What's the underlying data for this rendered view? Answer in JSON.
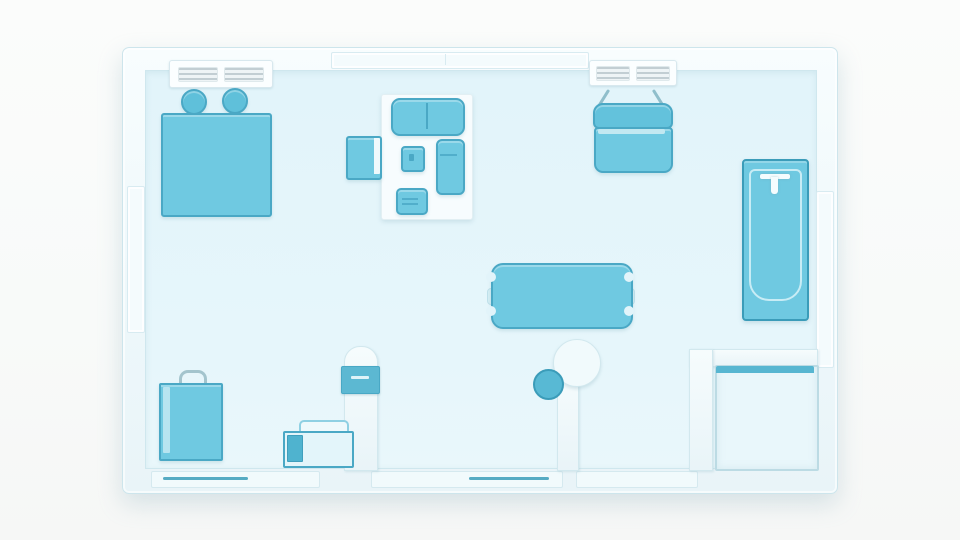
{
  "scene": {
    "title": "Apartment floor plan - top-down 3D illustration",
    "visible_text": "none"
  },
  "palette": {
    "page_bg": "#fafbfa",
    "wall_fill": "#eef8fb",
    "wall_edge": "#cde5ec",
    "wall_highlight": "#f8fdfe",
    "floor": "#e2f4fa",
    "furniture": "#6fc9e1",
    "furniture_edge": "#4aa8c5",
    "accent_dark": "#3b9cb9",
    "panel_teal": "#5cb8d2",
    "rug": "#f7fcfe",
    "window_fill": "#f4fbfd",
    "vent_slat": "#c2ced3",
    "appliance_body": "#e3f5fa",
    "shadow": "rgba(140,175,188,0.30)"
  },
  "furniture": {
    "bed": "double bed",
    "pillow_left": "round pillow",
    "pillow_right": "round pillow",
    "vent_left": "wall air vent",
    "vent_right": "wall air vent",
    "rug": "living room rug",
    "loveseat": "two-seat sofa",
    "armchair": "armchair",
    "coffee_table": "coffee table",
    "chaise": "chaise lounge",
    "ottoman": "ottoman",
    "hanging_chair": "hanging chair",
    "bathtub": "bathtub",
    "faucet": "bath faucet",
    "dining_table": "dining table",
    "wall_panel": "wall control panel",
    "column": "round column",
    "stool": "round stool",
    "washer": "washer cabinet",
    "bag": "shopping bag",
    "appliance": "small appliance",
    "window_left": "window",
    "window_right": "window",
    "window_top": "window",
    "sill_left": "window sill",
    "sill_center": "window sill",
    "sill_right": "window sill"
  }
}
